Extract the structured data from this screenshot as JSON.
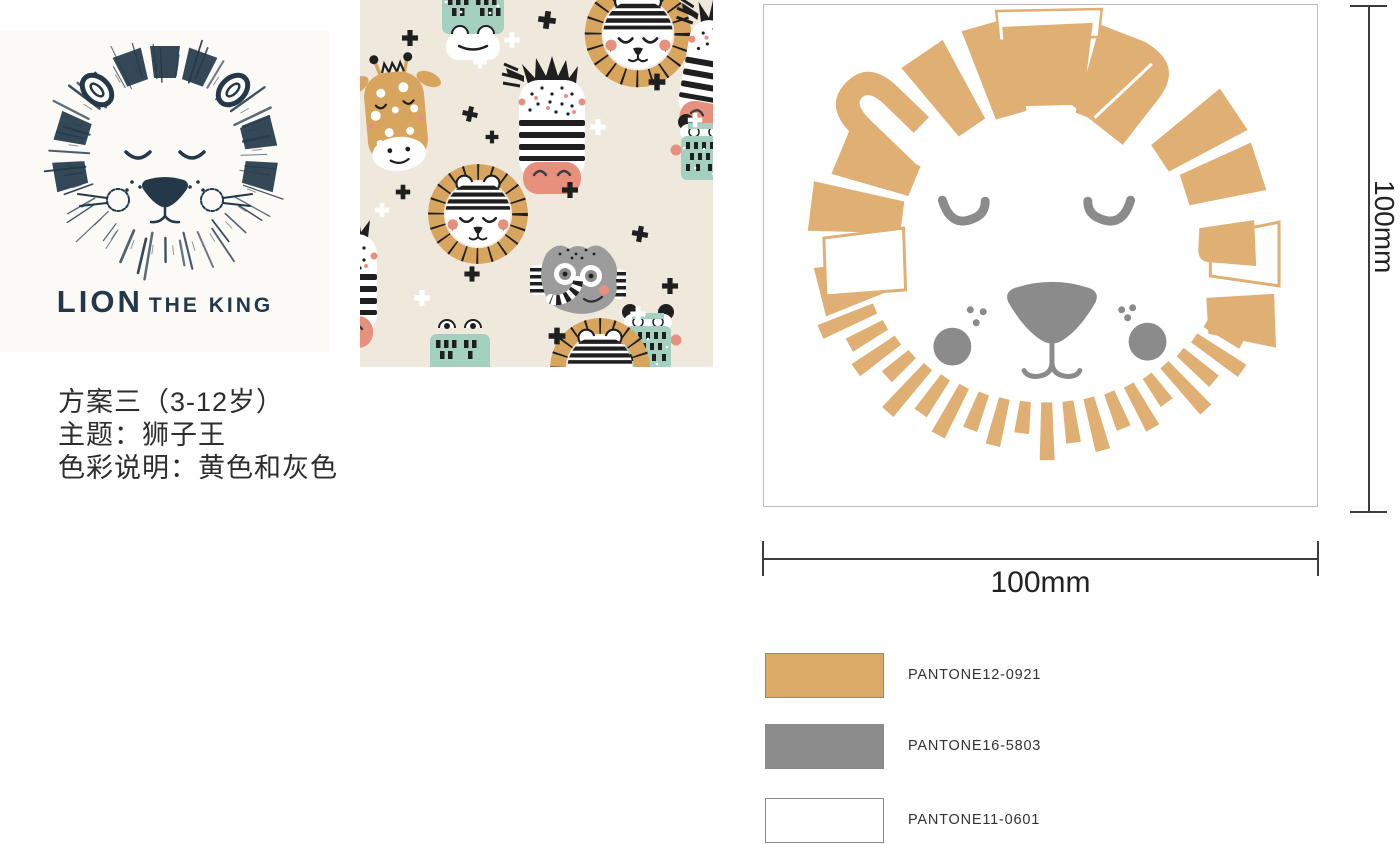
{
  "page": {
    "background": "#FFFFFF"
  },
  "logo": {
    "caption_main": "LION",
    "caption_rest": "THE KING",
    "color": "#24384A"
  },
  "pattern": {
    "background": "#EFE8DD",
    "tan": "#D8A55F",
    "mint": "#A3D0BF",
    "pink": "#E8907E",
    "black": "#1F1F1F",
    "gray": "#9C9C9C"
  },
  "proposal": {
    "lines": [
      "方案三（3-12岁）",
      "主题：狮子王",
      "色彩说明：黄色和灰色"
    ]
  },
  "artwork": {
    "tan": "#DFAF74",
    "gray": "#8B8B8B",
    "width_label": "100mm",
    "height_label": "100mm"
  },
  "palette": [
    {
      "pantone": "PANTONE12-0921",
      "hex": "#DCAA67"
    },
    {
      "pantone": "PANTONE16-5803",
      "hex": "#8C8C8C"
    },
    {
      "pantone": "PANTONE11-0601",
      "hex": "#FFFFFF"
    }
  ]
}
